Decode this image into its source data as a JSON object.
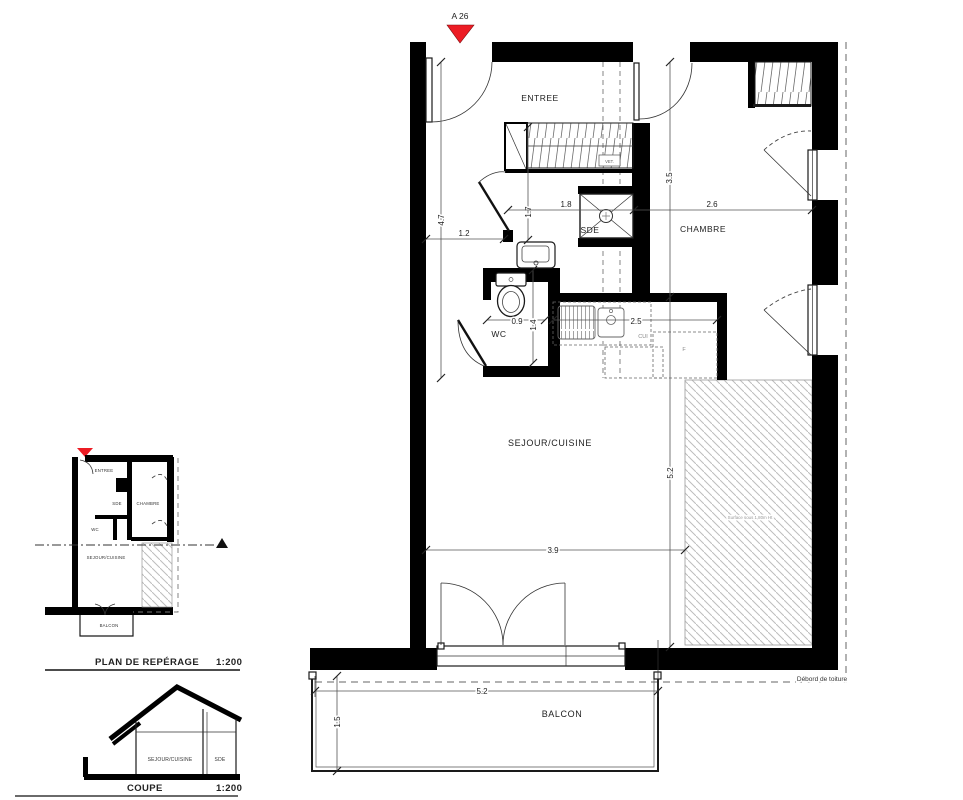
{
  "apartment_marker": {
    "label": "A 26",
    "triangle_color": "#ec1c24"
  },
  "main_plan": {
    "room_labels": {
      "entree": "ENTREE",
      "chambre": "CHAMBRE",
      "sde": "SDE",
      "wc": "WC",
      "sejour": "SEJOUR/CUISINE",
      "balcon": "BALCON"
    },
    "fixture_labels": {
      "kitchen": "CUI",
      "fridge": "F",
      "closet": "VET."
    },
    "dimensions": {
      "entry_hall_length": "4.7",
      "hall_width": "1.2",
      "sde_depth": "1.7",
      "sde_width": "1.8",
      "chambre_width": "2.6",
      "chambre_depth": "3.5",
      "wc_width": "0.9",
      "wc_depth": "1.4",
      "kitchen_length": "2.5",
      "sejour_width": "3.9",
      "sejour_length": "5.2",
      "balcon_width": "5.2",
      "balcon_depth": "1.5"
    },
    "annotations": {
      "roof_overhang": "Débord de toiture",
      "low_ceiling": "Surface sous 1,80m Ht"
    }
  },
  "reference_plan": {
    "title": "PLAN DE REPÉRAGE",
    "scale": "1:200",
    "room_labels": {
      "entree": "ENTREE",
      "sde": "SDE",
      "chambre": "CHAMBRE",
      "wc": "WC",
      "sejour": "SEJOUR/CUISINE",
      "balcon": "BALCON"
    }
  },
  "section_view": {
    "title": "COUPE",
    "scale": "1:200",
    "room_labels": {
      "sejour": "SEJOUR/CUISINE",
      "sde": "SDE"
    }
  }
}
